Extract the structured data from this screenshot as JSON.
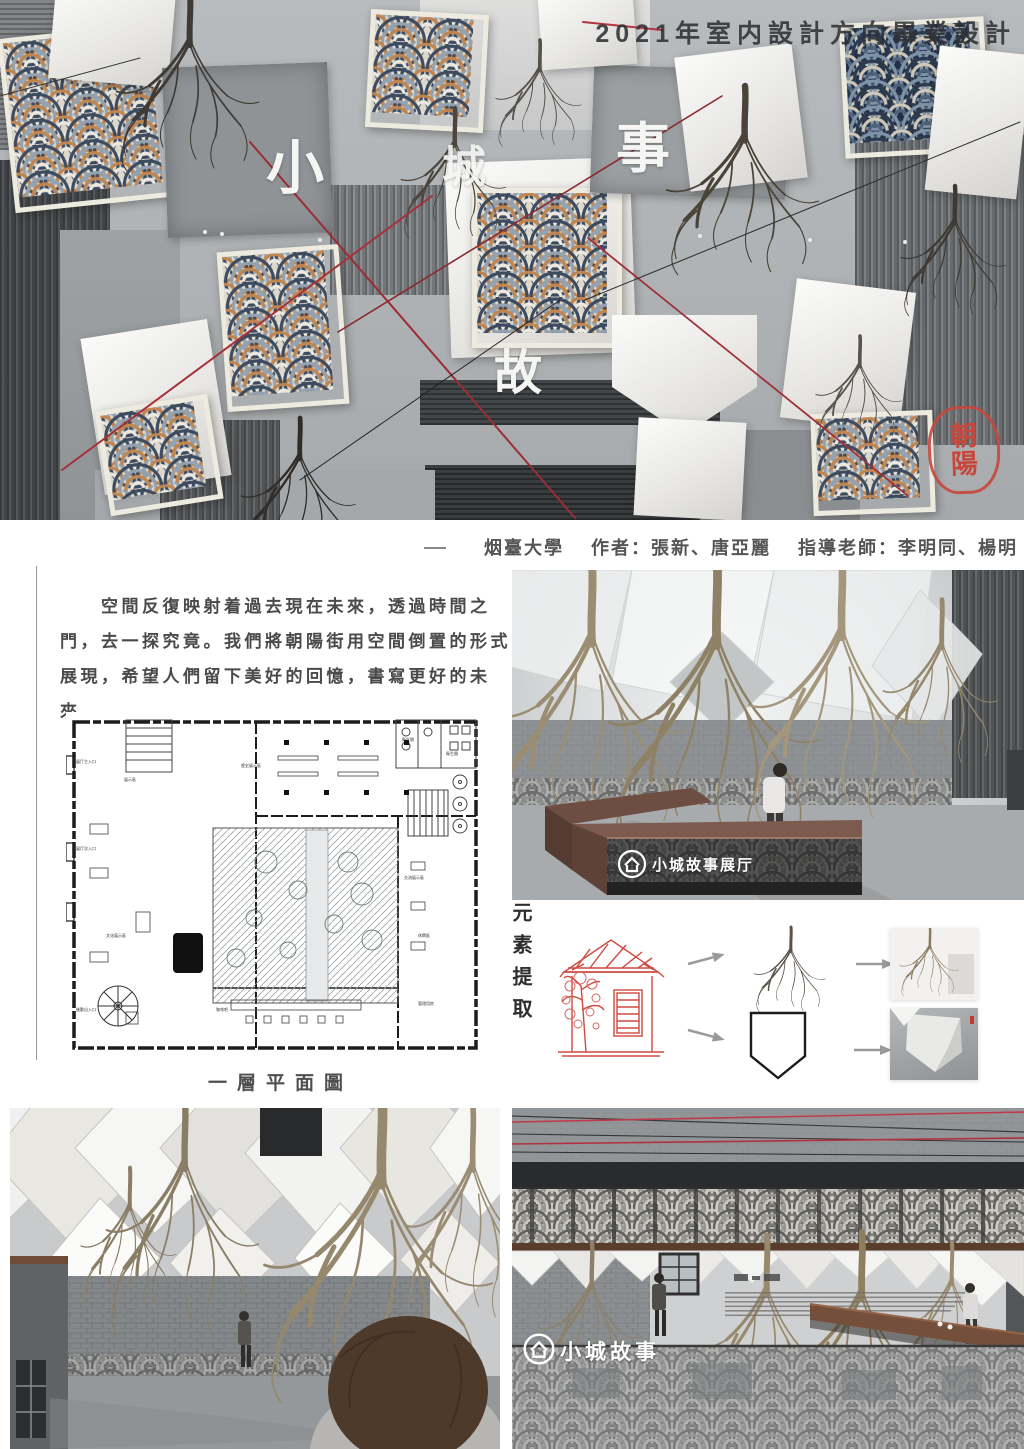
{
  "poster": {
    "title": "2021年室内設計方向畢業設計",
    "credits": "烟臺大學　 作者：張新、唐亞麗　 指導老師：李明同、楊明",
    "intro_paragraph": "　　空間反復映射着過去現在未來，透過時間之門，去一探究竟。我們將朝陽街用空間倒置的形式展現，希望人們留下美好的回憶，書寫更好的未來。"
  },
  "hero": {
    "scattered_chars": {
      "xiao": "小",
      "cheng": "城",
      "shi": "事",
      "gu": "故"
    },
    "seal": {
      "top": "朝",
      "bottom": "陽"
    }
  },
  "floorplan": {
    "caption": "一層平面圖",
    "labels": {
      "hall": "歷史展示區",
      "left_zone": "展示區",
      "culture_zone": "文化展示區",
      "exchange_zone": "交流展示區",
      "rest_zone": "休閑區",
      "coffee_bar": "咖啡吧",
      "office": "管理用房",
      "wc1": "衛生間",
      "wc2": "衛生間",
      "entrance_main": "展厅主入口",
      "entrance_side": "展厅次入口",
      "entrance_back": "後勤出入口"
    }
  },
  "element_extraction": {
    "label": "元素提取"
  },
  "reception": {
    "desk_sign": "小城故事展厅"
  },
  "bottom_right": {
    "wall_logo": "小城故事"
  },
  "palette": {
    "seal_red": "#c7473d",
    "accent_red": "#a03038",
    "pattern_navy": "#3d4b60",
    "pattern_rust": "#c1854f",
    "wood_brown": "#74503c"
  }
}
